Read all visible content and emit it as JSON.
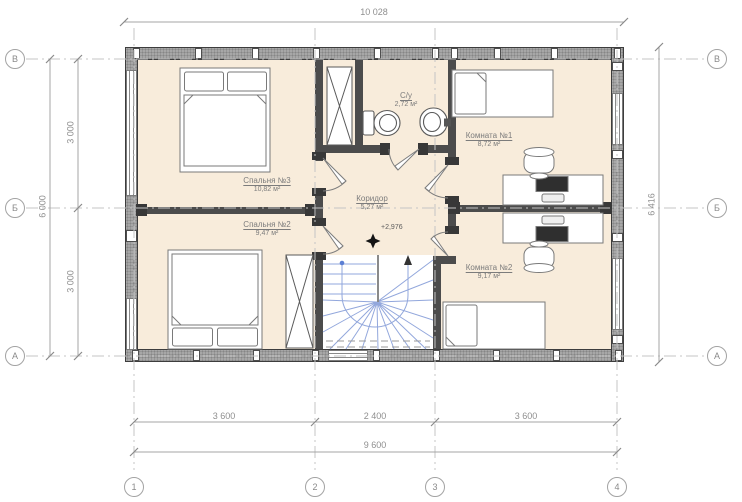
{
  "drawing": {
    "rooms": [
      {
        "name": "Спальня №3",
        "area": "10,82 м²"
      },
      {
        "name": "Спальня №2",
        "area": "9,47 м²"
      },
      {
        "name": "С/у",
        "area": "2,72 м²"
      },
      {
        "name": "Коридор",
        "area": "5,27 м²"
      },
      {
        "name": "Комната №1",
        "area": "8,72 м²"
      },
      {
        "name": "Комната №2",
        "area": "9,17 м²"
      }
    ],
    "elevation_mark": "+2,976",
    "dimensions": {
      "top": "10 028",
      "left_total": "6 000",
      "left_upper": "3 000",
      "left_lower": "3 000",
      "right_total": "6 416",
      "bottom_left": "3 600",
      "bottom_center": "2 400",
      "bottom_right": "3 600",
      "bottom_total": "9 600"
    },
    "axes": {
      "horizontal": [
        "В",
        "Б",
        "А"
      ],
      "vertical": [
        "1",
        "2",
        "3",
        "4"
      ]
    },
    "colors": {
      "floor": "#f8ecdb",
      "exterior_wall": "#a7a7a7",
      "interior_wall": "#4c4c4c",
      "stair_line": "#92a7dc",
      "dimension_text": "#8f8f8f",
      "label_text": "#7c7c7c"
    }
  }
}
